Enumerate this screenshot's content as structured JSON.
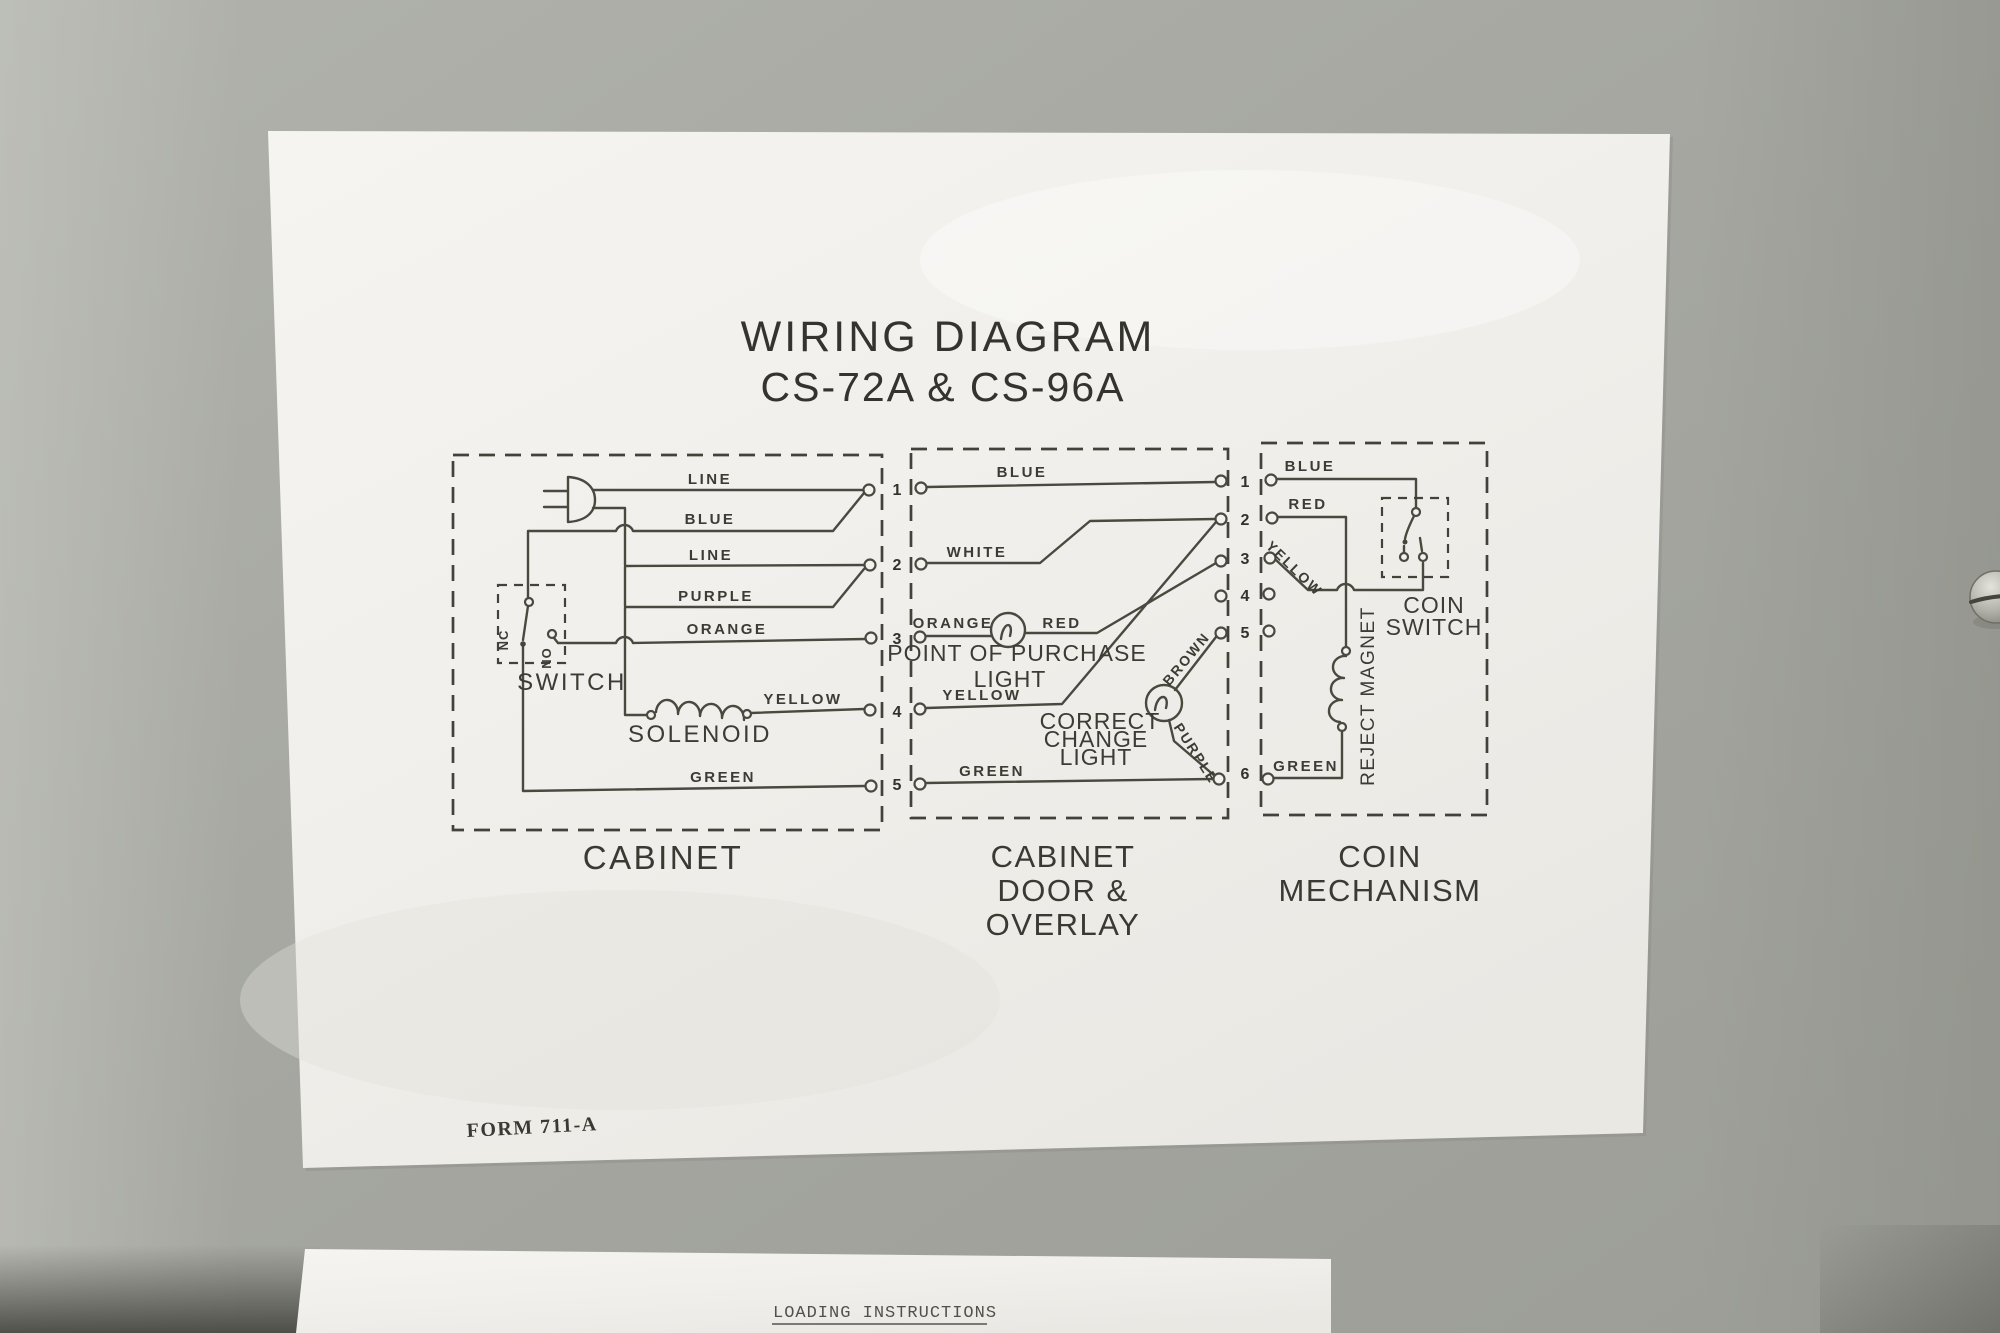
{
  "colors": {
    "wall": "#a7a8a2",
    "label_paper": "#f2f0ec",
    "ink": "#3c3c34"
  },
  "title": {
    "line1": "WIRING  DIAGRAM",
    "line2": "CS-72A & CS-96A"
  },
  "cabinet": {
    "caption": "CABINET",
    "wire_line_top": "LINE",
    "wire_blue": "BLUE",
    "wire_line_mid": "LINE",
    "wire_purple": "PURPLE",
    "wire_orange": "ORANGE",
    "wire_yellow": "YELLOW",
    "wire_green": "GREEN",
    "switch_label": "SWITCH",
    "nc": "NC",
    "no": "NO",
    "solenoid_label": "SOLENOID",
    "terminals": [
      "1",
      "2",
      "3",
      "4",
      "5"
    ]
  },
  "cabinet_door": {
    "caption_line1": "CABINET",
    "caption_line2": "DOOR &",
    "caption_line3": "OVERLAY",
    "wire_blue": "BLUE",
    "wire_white": "WHITE",
    "wire_orange": "ORANGE",
    "wire_red": "RED",
    "wire_yellow": "YELLOW",
    "wire_green": "GREEN",
    "wire_brown": "BROWN",
    "wire_purple": "PURPLE",
    "pop_light_line1": "POINT OF PURCHASE",
    "pop_light_line2": "LIGHT",
    "cc_light_line1": "CORRECT",
    "cc_light_line2": "CHANGE",
    "cc_light_line3": "LIGHT",
    "terminals": [
      "1",
      "2",
      "3",
      "4",
      "5",
      "6"
    ]
  },
  "coin_mechanism": {
    "caption_line1": "COIN",
    "caption_line2": "MECHANISM",
    "wire_blue": "BLUE",
    "wire_red": "RED",
    "wire_yellow": "YELLOW",
    "wire_green": "GREEN",
    "coin_switch_line1": "COIN",
    "coin_switch_line2": "SWITCH",
    "reject_magnet": "REJECT MAGNET"
  },
  "form_number": "FORM 711-A",
  "bottom_label": {
    "title": "LOADING INSTRUCTIONS"
  }
}
